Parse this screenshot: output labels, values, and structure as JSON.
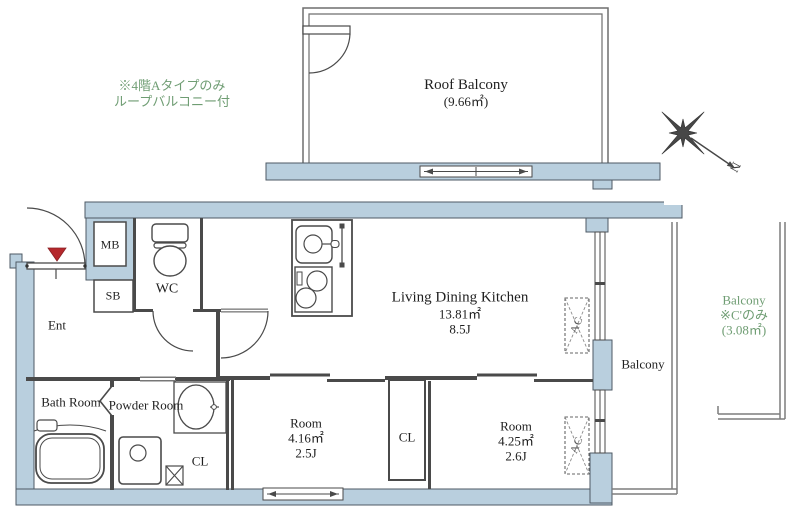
{
  "colors": {
    "wall_fill": "#b9cfde",
    "outline": "#4a4a4a",
    "rail": "#7d7d7d",
    "note_green": "#6f9d73",
    "entrance_marker_red": "#b5282c",
    "text": "#1f1f1f"
  },
  "roof_balcony": {
    "label": "Roof Balcony",
    "area": "(9.66㎡)"
  },
  "roof_note": {
    "line1": "※4階Aタイプのみ",
    "line2": "ループバルコニー付"
  },
  "compass": {
    "north_label": "N"
  },
  "unit": {
    "ldk": {
      "label": "Living Dining Kitchen",
      "area": "13.81㎡",
      "size": "8.5J"
    },
    "room_a": {
      "label": "Room",
      "area": "4.16㎡",
      "size": "2.5J"
    },
    "room_b": {
      "label": "Room",
      "area": "4.25㎡",
      "size": "2.6J"
    },
    "entrance": {
      "label": "Ent"
    },
    "toilet": {
      "label": "WC"
    },
    "meter_box": {
      "label": "MB"
    },
    "shoe_box": {
      "label": "SB"
    },
    "bathroom": {
      "label": "Bath Room"
    },
    "powder_room": {
      "label": "Powder Room"
    },
    "closet_hall": {
      "label": "CL"
    },
    "closet_rooms": {
      "label": "CL"
    },
    "air_con": {
      "label": "AC"
    },
    "balcony": {
      "label": "Balcony"
    }
  },
  "c_balcony_note": {
    "line1": "Balcony",
    "line2": "※C'のみ",
    "line3": "(3.08㎡)"
  }
}
